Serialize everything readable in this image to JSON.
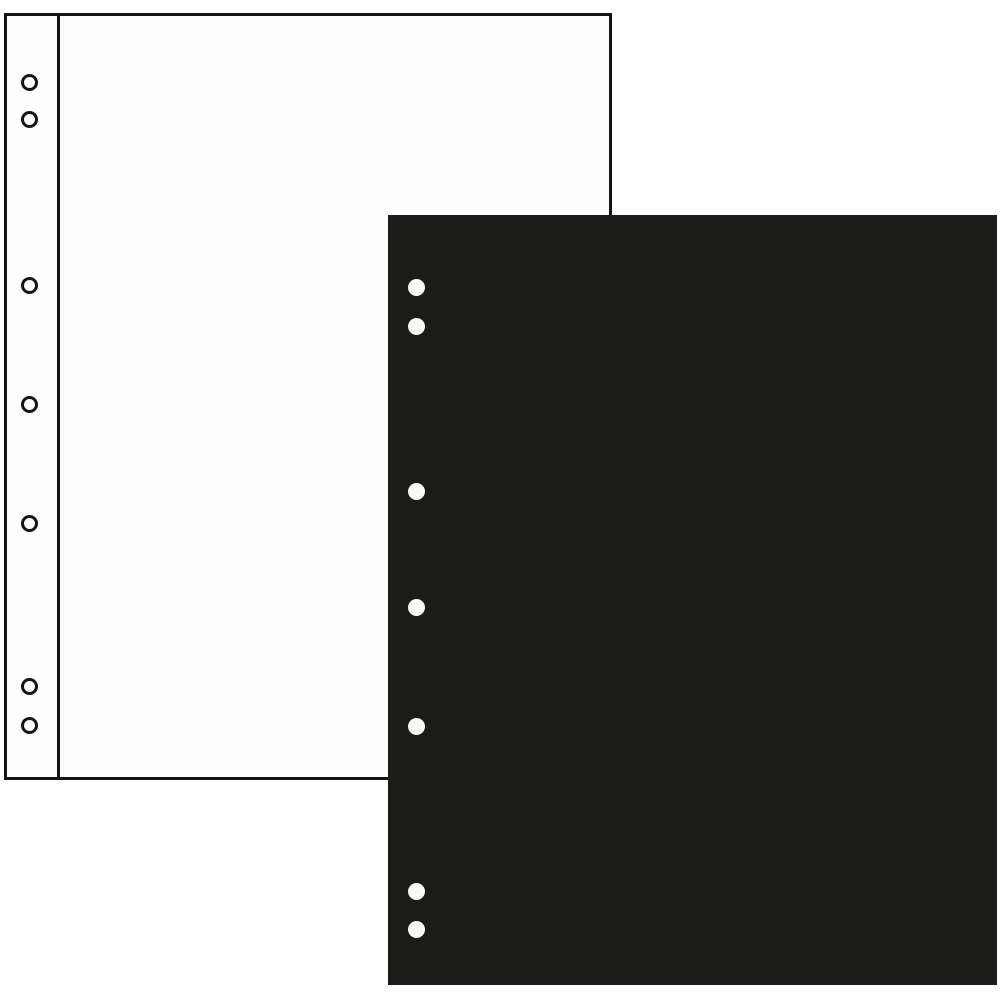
{
  "scene": {
    "width": 1000,
    "height": 1000,
    "background_color": "#ffffff",
    "description": "Product photo of two ring-binder album refill pages: a white outlined page behind and a solid black page in front, each punched with seven binder holes along the left edge (two at top, three in the middle, two at bottom)."
  },
  "white_page": {
    "x": 4,
    "y": 13,
    "width": 608,
    "height": 767,
    "fill": "#fefefe",
    "outline_color": "#141414",
    "outline_width": 3,
    "binding_line_x": 57,
    "binding_line_width": 3,
    "binding_line_color": "#141414",
    "hole_style": "outlined-ring",
    "hole_inner_color": "#ffffff",
    "hole_ring_color": "#141414",
    "hole_inner_diameter": 11,
    "hole_ring_width": 3,
    "hole_center_x": 29,
    "holes_y": [
      82,
      119,
      285,
      404,
      523,
      686,
      725
    ]
  },
  "black_page": {
    "x": 388,
    "y": 215,
    "width": 609,
    "height": 770,
    "fill": "#1b1b18",
    "outline_width": 0,
    "hole_style": "solid",
    "hole_fill": "#fafaf8",
    "hole_diameter": 17,
    "hole_center_x": 416,
    "holes_y": [
      287,
      326,
      491,
      607,
      726,
      891,
      929
    ]
  }
}
